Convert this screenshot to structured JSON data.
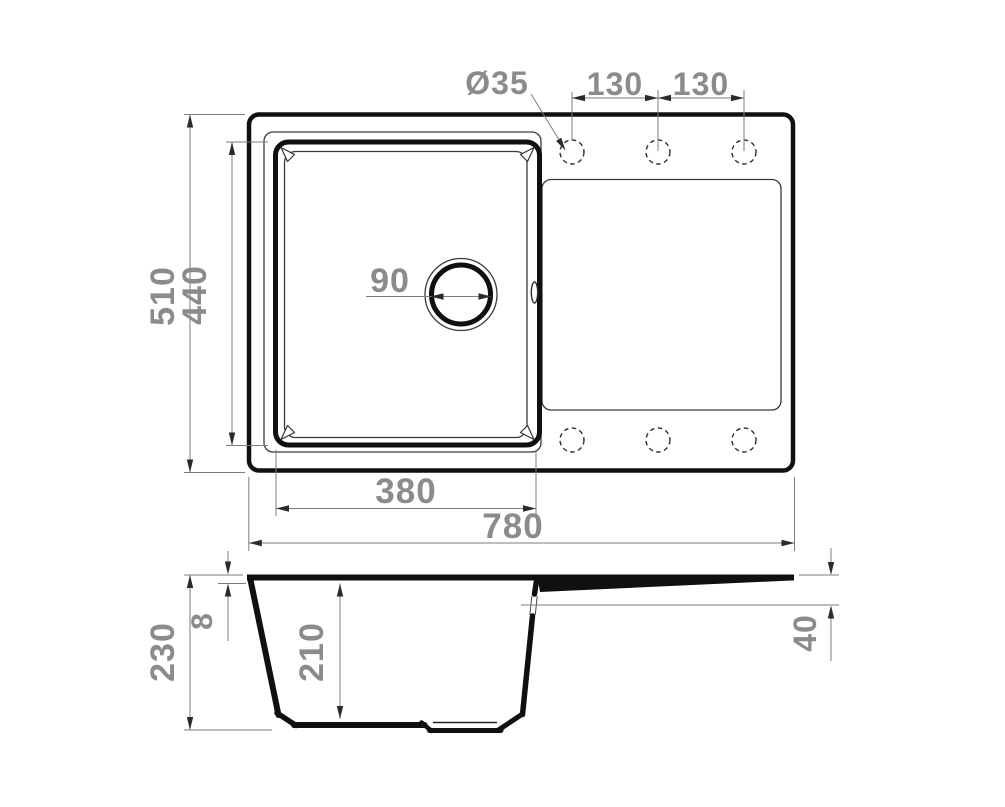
{
  "colors": {
    "line": "#101010",
    "thin_line": "#3a3a3a",
    "dimension_line": "#7d7d7d",
    "dimension_text": "#8b8b8b",
    "background": "#ffffff"
  },
  "top_view": {
    "labels": {
      "faucet_hole_diameter": "Ø35",
      "hole_spacing_left": "130",
      "hole_spacing_right": "130",
      "overall_depth": "510",
      "bowl_outer_depth": "440",
      "drain_diameter": "90",
      "bowl_outer_width": "380",
      "overall_width": "780"
    }
  },
  "side_view": {
    "labels": {
      "overall_height": "230",
      "rim_thickness": "8",
      "bowl_depth": "210",
      "overflow_drop": "40"
    }
  }
}
